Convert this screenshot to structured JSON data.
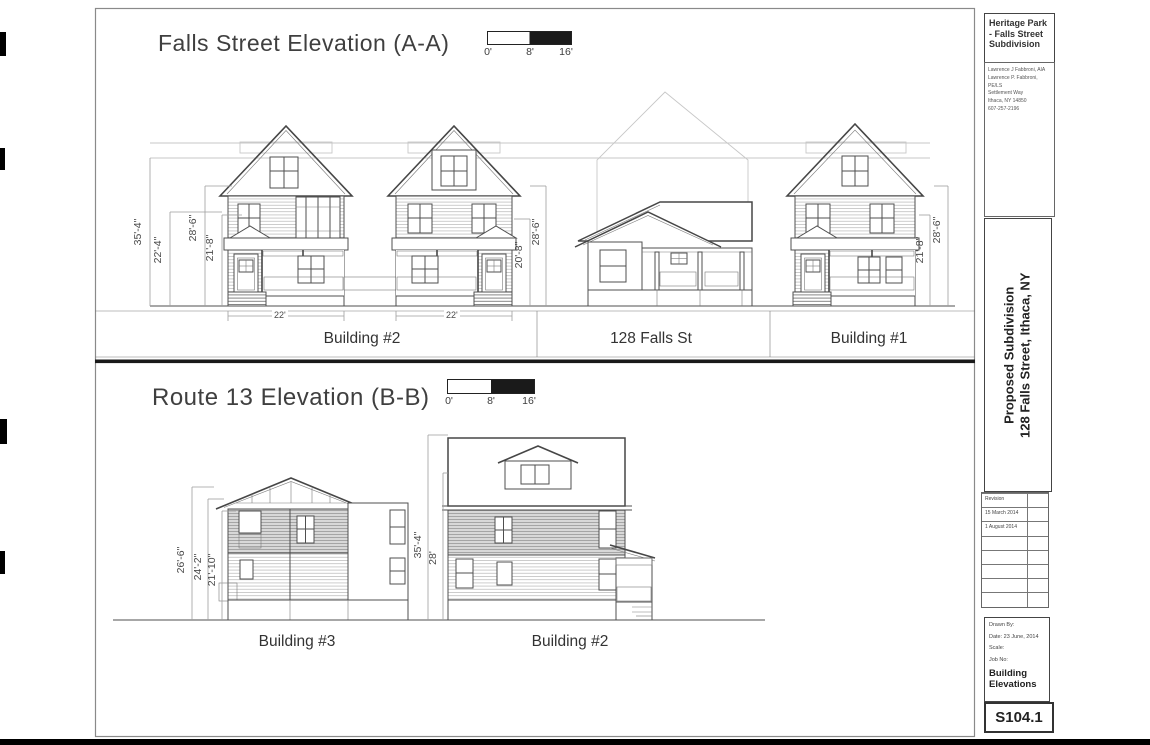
{
  "elevation_a": {
    "title": "Falls Street Elevation (A-A)",
    "scale_ticks": [
      "0'",
      "8'",
      "16'"
    ],
    "dims": {
      "overall": "35'-4\"",
      "left_mid": "22'-4\"",
      "ridge_left": "28'-6\"",
      "eave_left": "21'-8\"",
      "mid_height": "20'-8\"",
      "ridge_mid": "28'-6\"",
      "eave_right": "21'-8\"",
      "ridge_right": "28'-6\"",
      "width_left": "22'",
      "width_right": "22'"
    },
    "labels": {
      "left": "Building #2",
      "center": "128 Falls St",
      "right": "Building #1"
    }
  },
  "elevation_b": {
    "title": "Route 13 Elevation (B-B)",
    "scale_ticks": [
      "0'",
      "8'",
      "16'"
    ],
    "dims": {
      "h1": "26'-6\"",
      "h2": "24'-2\"",
      "h3": "21'-10\"",
      "h4": "35'-4\"",
      "h5": "28'"
    },
    "labels": {
      "left": "Building #3",
      "right": "Building #2"
    }
  },
  "title_block": {
    "project_name": "Heritage Park - Falls Street Subdivision",
    "firm_lines": [
      "Lawrence J Fabbroni, AIA",
      "Lawrence P. Fabbroni, PE/LS",
      "Settlement Way",
      "Ithaca, NY 14850",
      "607-257-2196"
    ],
    "drawing_title_line1": "Proposed Subdivision",
    "drawing_title_line2": "128 Falls Street, Ithaca, NY",
    "revision_header": "Revision",
    "revisions": [
      "15 March 2014",
      "1 August 2014"
    ],
    "drawn_by_label": "Drawn By:",
    "date_label": "Date: 23 June, 2014",
    "scale_label": "Scale:",
    "job_no_label": "Job No:",
    "sheet_title_line1": "Building",
    "sheet_title_line2": "Elevations",
    "sheet_number": "S104.1"
  },
  "colors": {
    "line": "#4f4f4f",
    "faint": "#c7c7c7",
    "black": "#1a1a1a"
  }
}
